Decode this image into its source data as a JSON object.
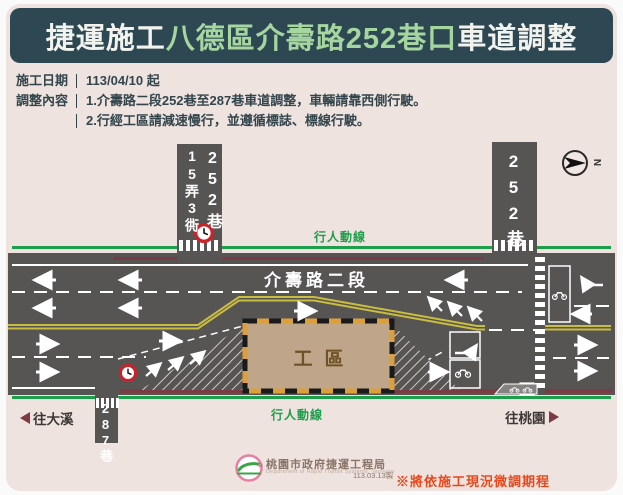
{
  "title": {
    "prefix": "捷運施工",
    "highlight": "八德區介壽路252巷口",
    "suffix": "車道調整"
  },
  "info": {
    "date_label": "施工日期",
    "date_value": "113/04/10 起",
    "content_label": "調整內容",
    "content_line1": "1.介壽路二段252巷至287巷車道調整，車輛請靠西側行駛。",
    "content_line2": "2.行經工區請減速慢行，並遵循標誌、標線行駛。"
  },
  "map": {
    "road_name": "介壽路二段",
    "side_road_northwest_left": "15弄3衖",
    "side_road_northwest_right": "252巷",
    "side_road_northeast": "252巷",
    "side_road_south": "287巷",
    "work_zone": "工區",
    "pedestrian_top": "行人動線",
    "pedestrian_bottom": "行人動線",
    "dir_west": "往大溪",
    "dir_east": "往桃園",
    "compass": "N"
  },
  "footer": {
    "agency": "桃園市政府捷運工程局",
    "agency_en": "Department of Rapid Transit Systems, Taoyuan",
    "made_date": "113.03.13製",
    "note": "※將依施工現況微調期程"
  },
  "colors": {
    "title_bg": "#2d4852",
    "title_highlight": "#a5d6a0",
    "poster_bg": "#eee3df",
    "road": "#575454",
    "pedestrian_green": "#1d9e4b",
    "no_parking_red": "#7c3a42",
    "center_yellow": "#c9bd3f",
    "work_zone_fill": "#bfa68a",
    "work_zone_border_orange": "#dba03c",
    "work_zone_text": "#6f5126",
    "sign_red": "#c8242c",
    "note_red": "#e8481c",
    "logo_pink": "#e87fa0",
    "logo_green": "#3aa548"
  }
}
